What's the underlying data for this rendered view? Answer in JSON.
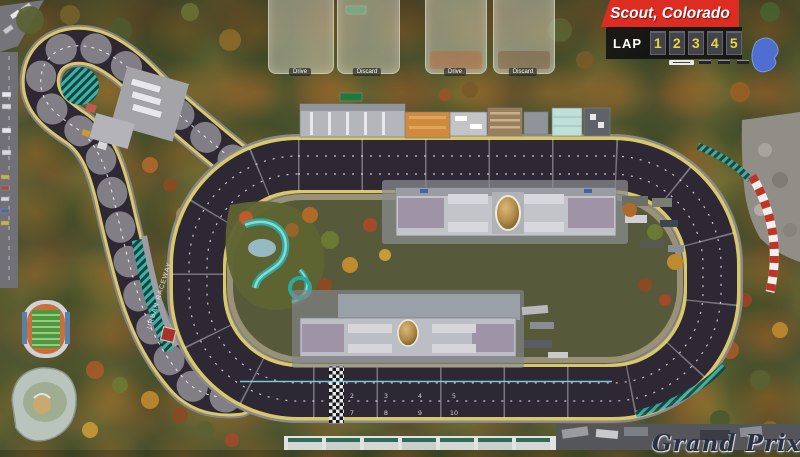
{
  "header": {
    "location": "Scout, Colorado",
    "lap": {
      "label": "LAP",
      "numbers": [
        "1",
        "2",
        "3",
        "4",
        "5"
      ]
    }
  },
  "footer": {
    "game_title": "Grand Prix"
  },
  "card_zones": {
    "zone1": "Drive",
    "zone2": "Discard",
    "zone3": "Drive",
    "zone4": "Discard"
  },
  "track": {
    "wall_text": "URBAN RACEWAY",
    "space_numbers": {
      "lane1": [
        "2",
        "3",
        "4",
        "5"
      ],
      "lane2": [
        "7",
        "8",
        "9",
        "10"
      ]
    }
  },
  "colors": {
    "banner_red": "#dd2d22",
    "lap_number_yellow": "#e9d63a",
    "track_surface": "#2e2835",
    "track_edge_yellow": "#d9c86a",
    "runoff_teal": "#39b3a8",
    "pit_line_cyan": "#82d8e8",
    "forest_olive": "#4d5430"
  }
}
